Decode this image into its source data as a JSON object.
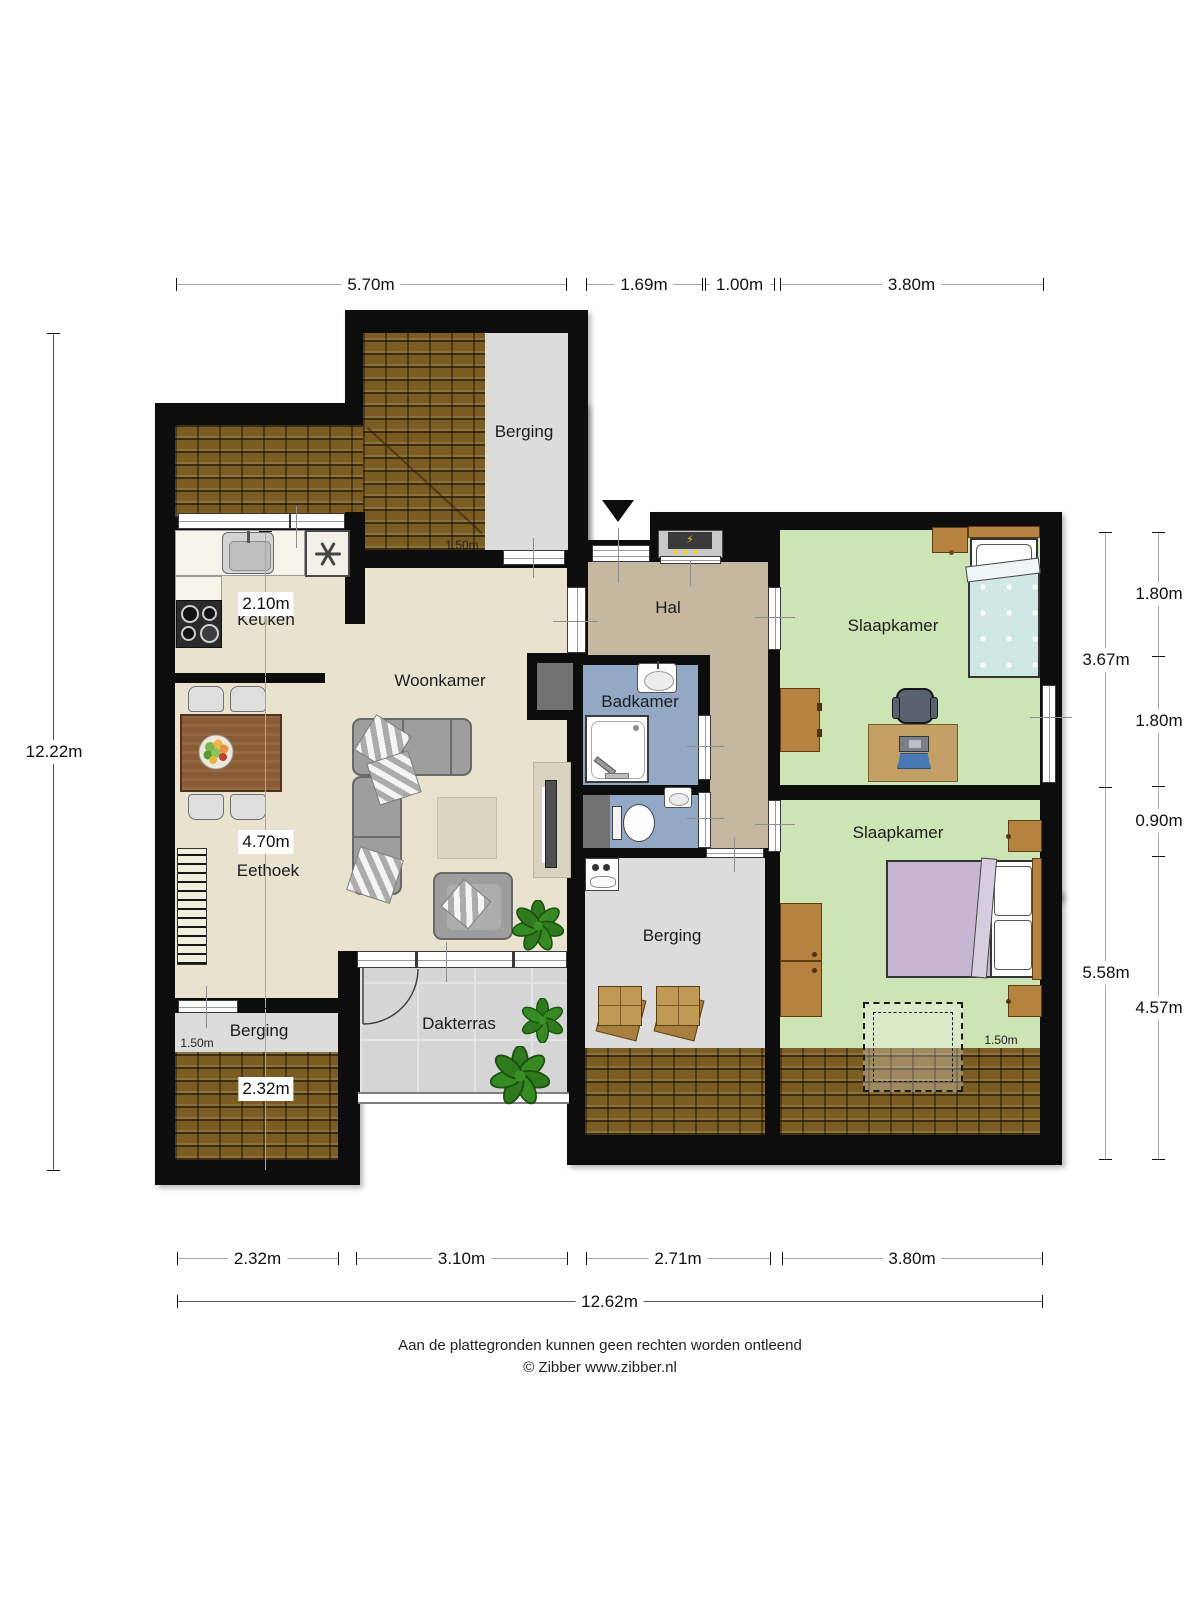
{
  "rooms": {
    "berging_top": "Berging",
    "keuken": "Keuken",
    "woonkamer": "Woonkamer",
    "eethoek": "Eethoek",
    "hal": "Hal",
    "badkamer": "Badkamer",
    "slaapkamer_1": "Slaapkamer",
    "slaapkamer_2": "Slaapkamer",
    "berging_mid": "Berging",
    "berging_left": "Berging",
    "dakterras": "Dakterras"
  },
  "height_markers": {
    "berging_top": "1.50m",
    "berging_left": "1.50m",
    "slaapkamer_2": "1.50m"
  },
  "dimensions": {
    "top": [
      "5.70m",
      "1.69m",
      "1.00m",
      "3.80m"
    ],
    "bottom": [
      "2.32m",
      "3.10m",
      "2.71m",
      "3.80m"
    ],
    "bottom_total": "12.62m",
    "left": [
      "2.10m",
      "4.70m",
      "2.32m"
    ],
    "left_total": "12.22m",
    "right_inner": [
      "3.67m",
      "5.58m"
    ],
    "right_outer": [
      "1.80m",
      "1.80m",
      "0.90m",
      "4.57m"
    ]
  },
  "footer": {
    "line1": "Aan de plattegronden kunnen geen rechten worden ontleend",
    "line2": "© Zibber www.zibber.nl"
  },
  "colors": {
    "wall": "#0d0d0d",
    "floor_living": "#e9e2cf",
    "floor_hall": "#c5b7a0",
    "floor_bath": "#92a8c4",
    "floor_bedroom": "#cde4b4",
    "floor_storage": "#dcdcdc",
    "floor_terrace": "#d6d6d6",
    "roof_tiles": "#7b5c22"
  }
}
